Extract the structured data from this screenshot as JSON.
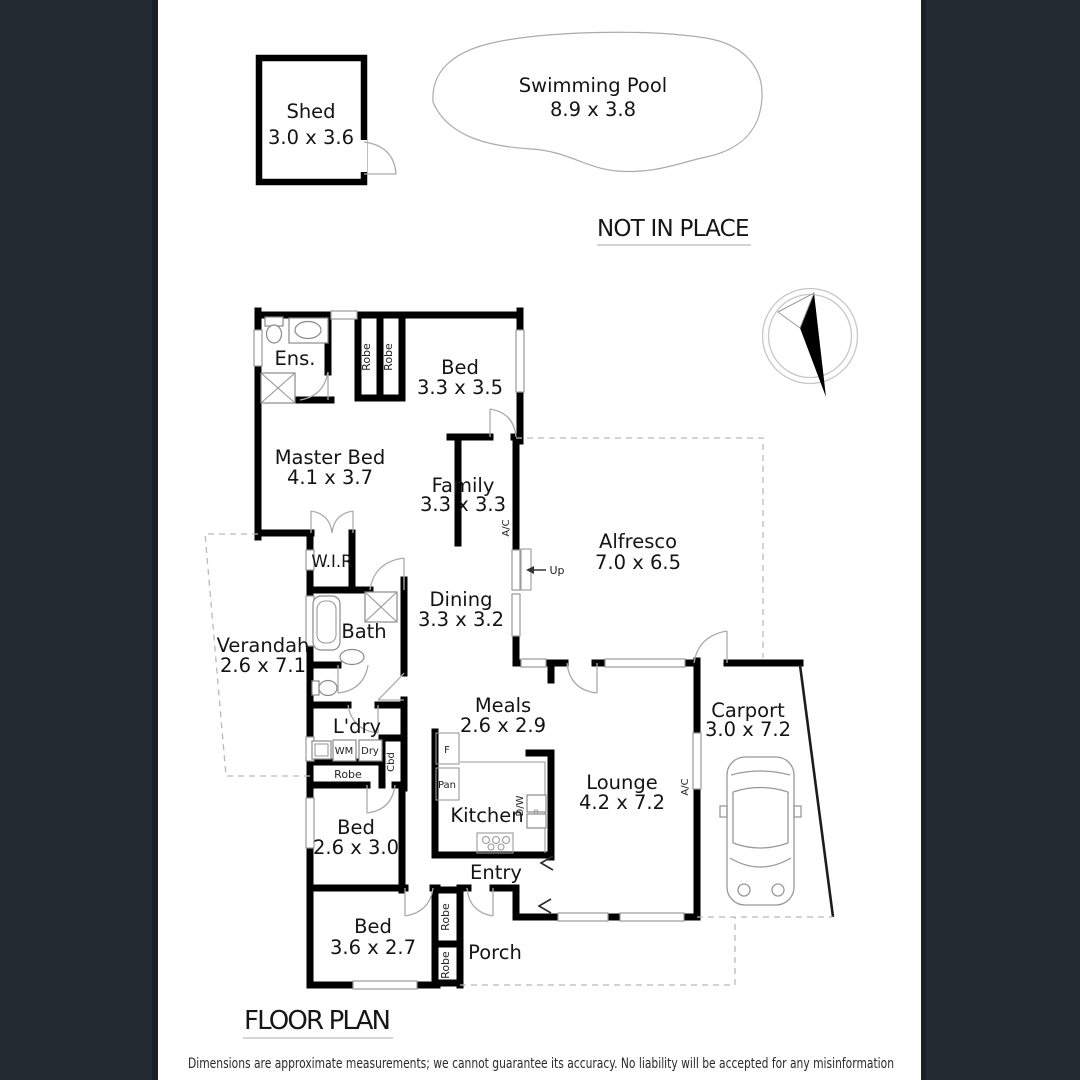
{
  "page": {
    "bg": "#ffffff",
    "frame_color": "#232a31",
    "frame_edge_color": "#1a2027"
  },
  "titles": {
    "not_in_place": "NOT IN PLACE",
    "floor_plan": "FLOOR PLAN",
    "disclaimer": "Dimensions are approximate measurements; we cannot guarantee its accuracy. No liability will be accepted for any misinformation"
  },
  "outbuildings": {
    "shed_name": "Shed",
    "shed_dims": "3.0 x 3.6",
    "pool_name": "Swimming Pool",
    "pool_dims": "8.9 x 3.8"
  },
  "rooms": {
    "ens": {
      "name": "Ens."
    },
    "bed1": {
      "name": "Bed",
      "dims": "3.3 x 3.5"
    },
    "master": {
      "name": "Master Bed",
      "dims": "4.1 x 3.7"
    },
    "family": {
      "name": "Family",
      "dims": "3.3 x 3.3"
    },
    "alfresco": {
      "name": "Alfresco",
      "dims": "7.0 x 6.5"
    },
    "wir": {
      "name": "W.I.R"
    },
    "dining": {
      "name": "Dining",
      "dims": "3.3 x 3.2"
    },
    "bath": {
      "name": "Bath"
    },
    "verandah": {
      "name": "Verandah",
      "dims": "2.6 x 7.1"
    },
    "meals": {
      "name": "Meals",
      "dims": "2.6 x 2.9"
    },
    "ldry": {
      "name": "L'dry"
    },
    "carport": {
      "name": "Carport",
      "dims": "3.0 x 7.2"
    },
    "lounge": {
      "name": "Lounge",
      "dims": "4.2 x 7.2"
    },
    "kitchen": {
      "name": "Kitchen"
    },
    "bed2": {
      "name": "Bed",
      "dims": "2.6 x 3.0"
    },
    "entry": {
      "name": "Entry"
    },
    "bed3": {
      "name": "Bed",
      "dims": "3.6 x 2.7"
    },
    "porch": {
      "name": "Porch"
    }
  },
  "fixtures": {
    "robe": "Robe",
    "wm": "WM",
    "dry": "Dry",
    "cbd": "Cbd",
    "fridge": "F",
    "pantry": "Pan",
    "dishwasher": "D/W",
    "ac": "A/C",
    "up": "Up"
  }
}
